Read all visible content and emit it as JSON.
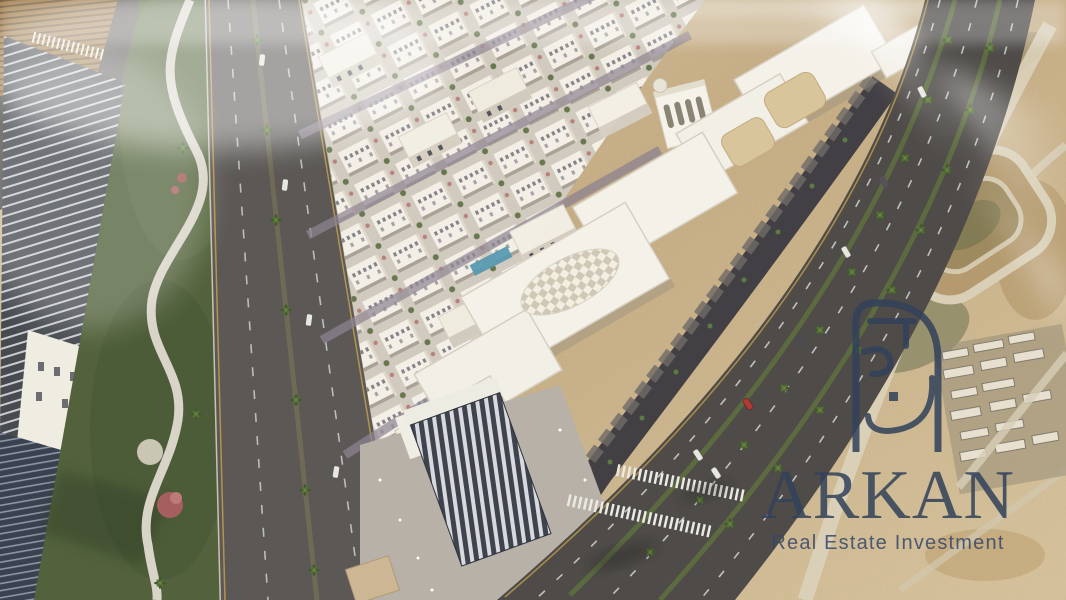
{
  "watermark": {
    "brand": "ARKAN",
    "tagline": "Real Estate Investment",
    "logo": "arkan-arch-monogram",
    "color": "#31415a"
  },
  "scene": {
    "type": "aerial-3d-render",
    "subject": "Aerial render of a mixed-use residential development with retail strip, palm boulevard, glass towers and surrounding desert",
    "palette": {
      "sand": "#c9b189",
      "sand_light": "#dbc9a4",
      "asphalt": "#4e4b48",
      "grass": "#53623c",
      "building_white": "#f3efe5",
      "glass_dark": "#474b50",
      "bloom_pink": "#a65f5e",
      "pool_blue": "#4f93ad",
      "watermark_navy": "#31415a"
    }
  }
}
